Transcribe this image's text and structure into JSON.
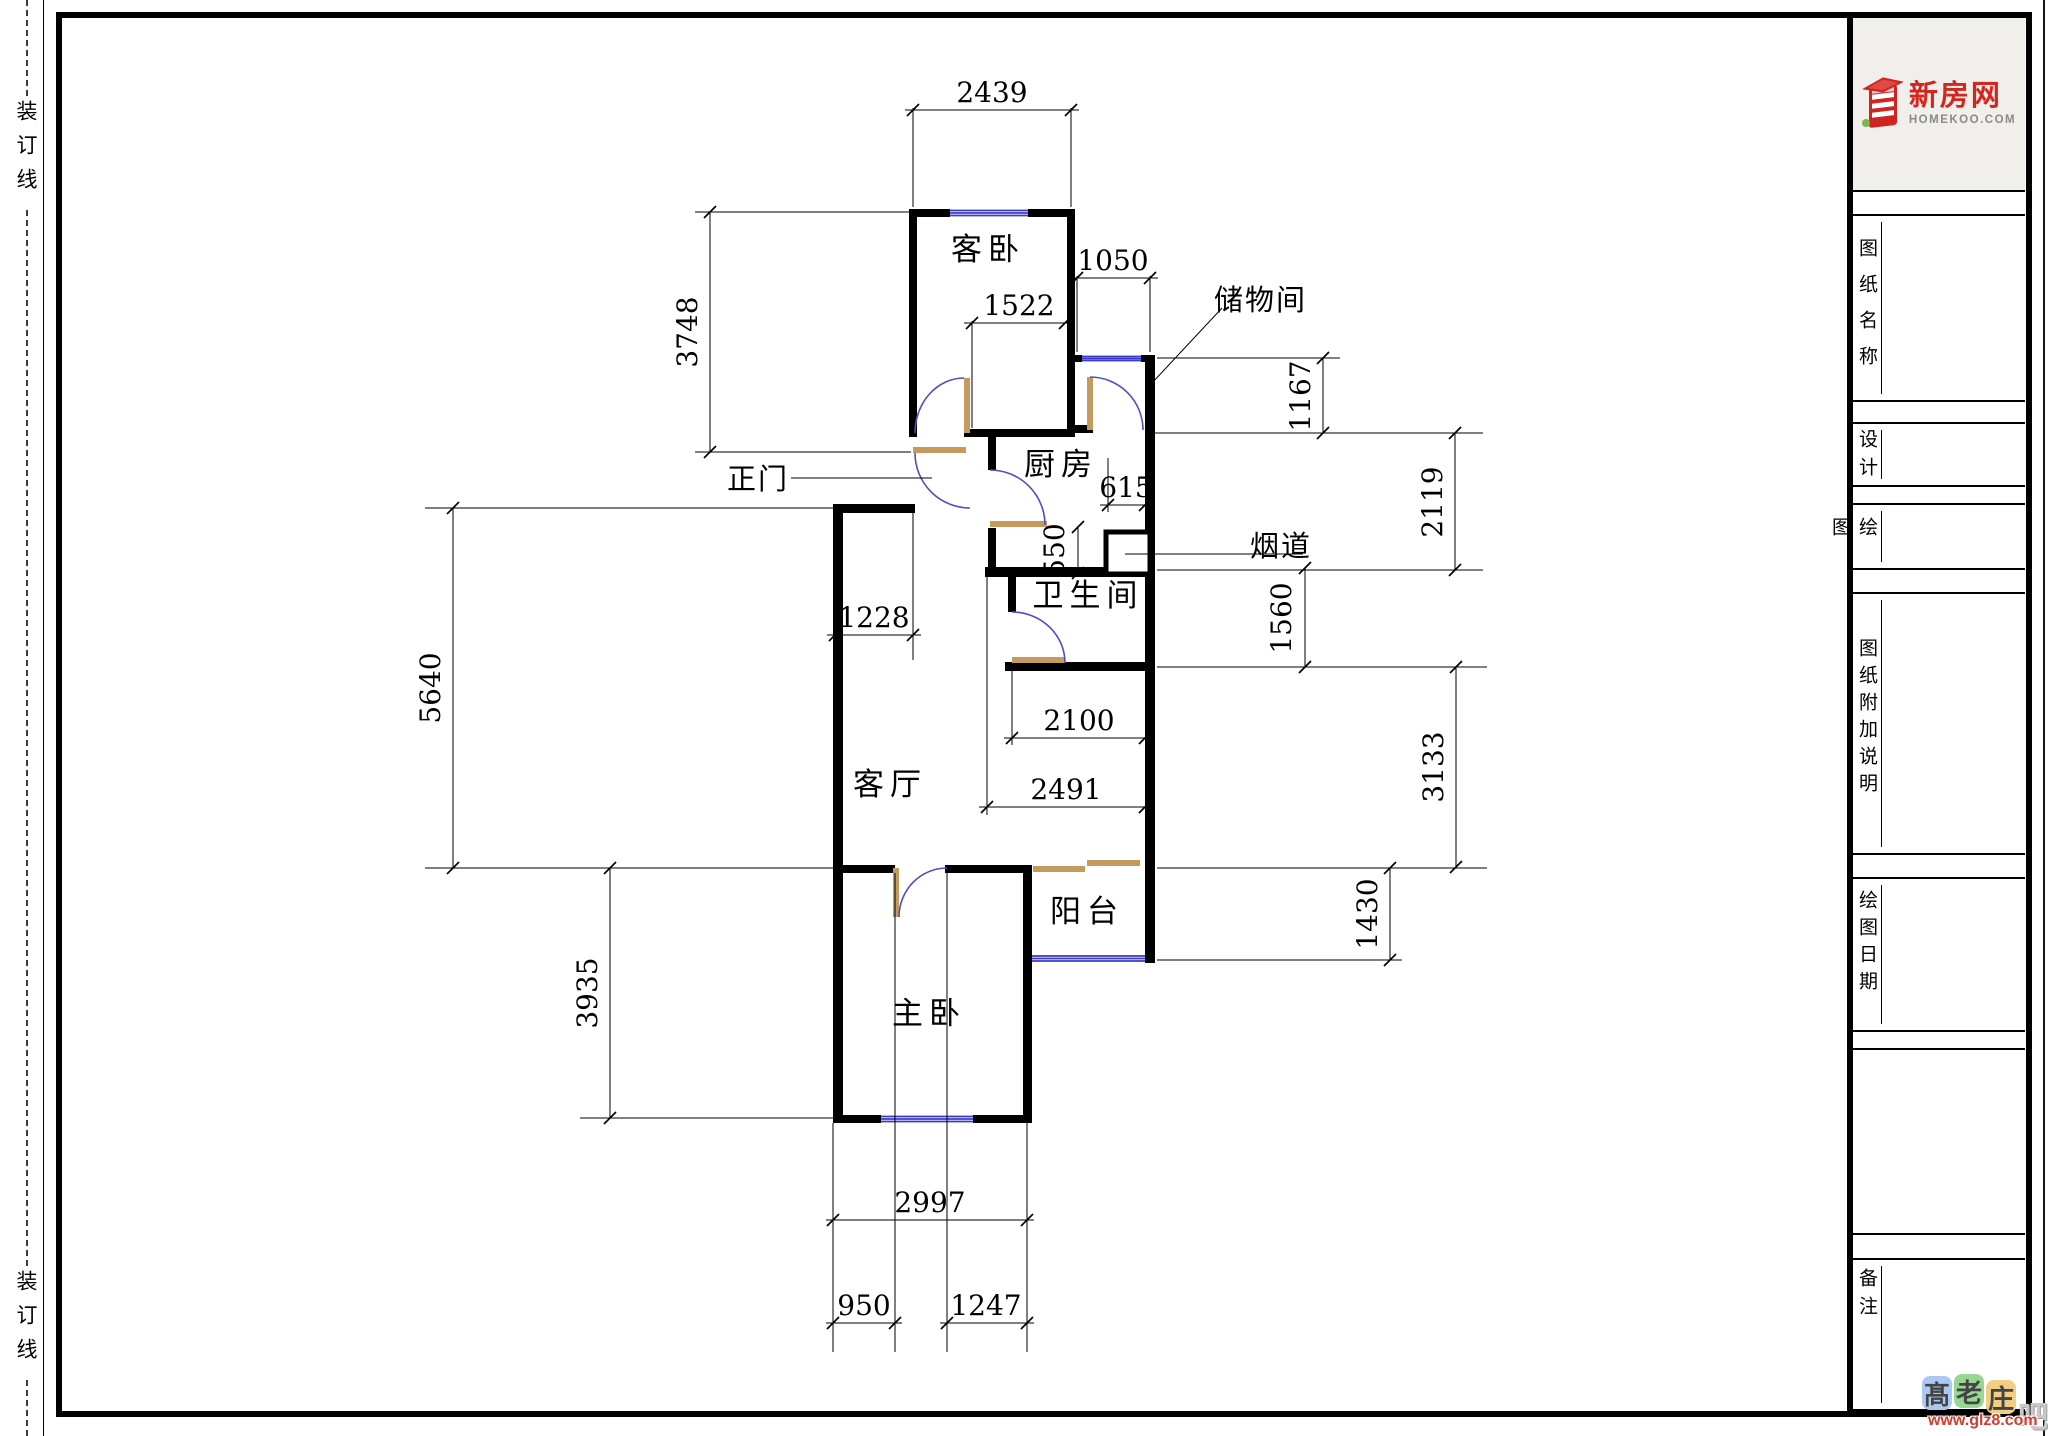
{
  "binding": {
    "top": "装订线",
    "bottom": "装订线"
  },
  "logo": {
    "brand": "新房网",
    "domain": "HOMEKOO.COM"
  },
  "titleblock": {
    "drawing_name_label": "图纸名称",
    "design_label": "设计",
    "drafting_label": "绘图",
    "notes_label": "图纸附加说明",
    "date_label": "绘图日期",
    "remarks_label": "备注"
  },
  "floorplan": {
    "rooms": {
      "guest_bedroom": "客卧",
      "storage": "储物间",
      "kitchen": "厨房",
      "bathroom": "卫生间",
      "living": "客厅",
      "balcony": "阳台",
      "master_bedroom": "主卧"
    },
    "callouts": {
      "main_door": "正门",
      "flue": "烟道"
    },
    "dims": {
      "d2439": "2439",
      "d3748": "3748",
      "d1050": "1050",
      "d1522": "1522",
      "d1167": "1167",
      "d2119": "2119",
      "d615": "615",
      "d550": "550",
      "d1560": "1560",
      "d1228": "1228",
      "d5640": "5640",
      "d2100": "2100",
      "d2491": "2491",
      "d3133": "3133",
      "d1430": "1430",
      "d3935": "3935",
      "d2997": "2997",
      "d950": "950",
      "d1247": "1247"
    }
  },
  "watermark": {
    "char1": "髙",
    "char2": "老",
    "char3": "庄",
    "char4": "吧",
    "url": "www.glz8.com"
  },
  "colors": {
    "wall": "#000000",
    "window": "#3a3ac8",
    "door_leaf": "#c49a5e",
    "door_arc": "#4d4dc8",
    "logo_red": "#d5251d",
    "logo_gray": "#8a8a8a"
  }
}
